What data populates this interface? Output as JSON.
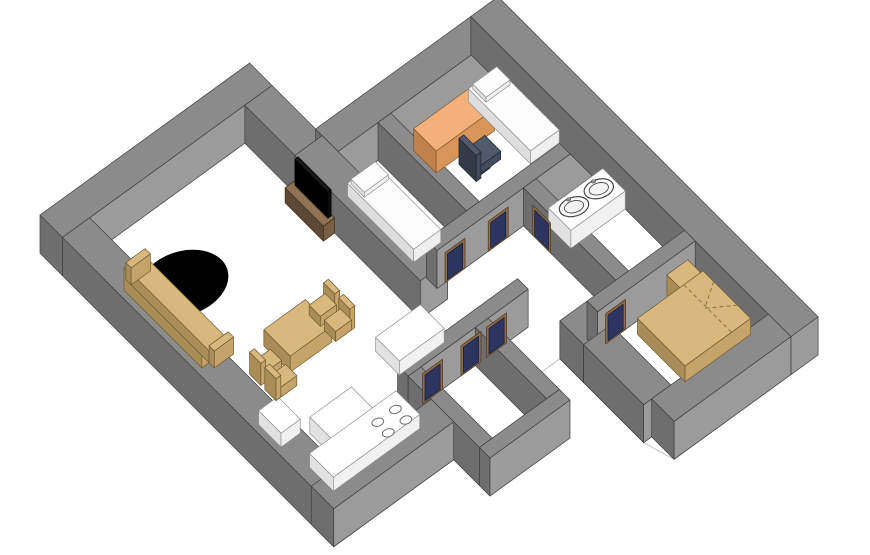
{
  "scene": {
    "width": 870,
    "height": 555,
    "background": "#ffffff",
    "label": "3D axonometric apartment floor plan rendering"
  },
  "projection": {
    "origin": [
      40,
      253
    ],
    "eu": [
      0.8,
      -0.58
    ],
    "ev": [
      0.66,
      0.66
    ],
    "wall_height": 38
  },
  "palette": {
    "wall": {
      "t": "#8b8b8b",
      "l": "#6e6e6e",
      "f": "#9b9b9b",
      "s": "#3f3f3f"
    },
    "tan": {
      "t": "#d9b87e",
      "l": "#aa8c57",
      "f": "#c4a469",
      "s": "#6e5a32"
    },
    "whitefurn": {
      "t": "#ffffff",
      "l": "#e2e2e2",
      "f": "#f1f1f1",
      "s": "#8f8f8f"
    },
    "whitebed": {
      "t": "#fdfdfd",
      "l": "#dedede",
      "f": "#efefef",
      "s": "#909090"
    },
    "orange": {
      "t": "#f2b17b",
      "l": "#bf8049",
      "f": "#d99459",
      "s": "#7b5930"
    },
    "brown": {
      "t": "#8f7355",
      "l": "#5e4a34",
      "f": "#785e43",
      "s": "#3c2f1f"
    },
    "black": {
      "t": "#1a1a1a",
      "l": "#000000",
      "f": "#101010",
      "s": "#000000"
    },
    "slate": {
      "t": "#505a6c",
      "l": "#343b48",
      "f": "#434d5d",
      "s": "#20252d"
    },
    "door": {
      "frame": "#8a6c49",
      "frame_stroke": "#57402a",
      "panel": "#2b3560",
      "panel_stroke": "#151d3a"
    },
    "floor": {
      "fill": "#ffffff",
      "stroke": "#c2c2c2"
    },
    "rug": "#000000",
    "sink_stroke": "#474747",
    "burner_stroke": "#6f6f6f",
    "bedline": "#8a744c"
  },
  "floor": {
    "name": "floor-slab",
    "pts": [
      [
        0,
        0
      ],
      [
        262,
        0
      ],
      [
        262,
        100
      ],
      [
        490,
        100
      ],
      [
        490,
        585
      ],
      [
        310,
        585
      ],
      [
        300,
        551
      ],
      [
        300,
        424
      ],
      [
        250,
        424
      ],
      [
        250,
        500
      ],
      [
        150,
        500
      ],
      [
        150,
        445
      ],
      [
        0,
        445
      ]
    ]
  },
  "walls": [
    {
      "name": "wall-nw-living",
      "u": 0,
      "v": 0,
      "du": 262,
      "dv": 34
    },
    {
      "name": "wall-jog-living-ne",
      "u": 228,
      "v": 34,
      "du": 34,
      "dv": 76
    },
    {
      "name": "wall-nw-bedrooms",
      "u": 262,
      "v": 100,
      "du": 194,
      "dv": 34
    },
    {
      "name": "wall-divider-bedrooms",
      "u": 312,
      "v": 134,
      "du": 16,
      "dv": 134
    },
    {
      "name": "wall-ne-living",
      "u": 228,
      "v": 110,
      "du": 34,
      "dv": 190
    },
    {
      "name": "wall-hall-nw",
      "u": 262,
      "v": 268,
      "du": 194,
      "dv": 16
    },
    {
      "name": "wall-bath-sw",
      "u": 370,
      "v": 284,
      "du": 16,
      "dv": 140
    },
    {
      "name": "wall-ne-outer",
      "u": 456,
      "v": 100,
      "du": 34,
      "dv": 485
    },
    {
      "name": "wall-sw-living",
      "u": 0,
      "v": 34,
      "du": 34,
      "dv": 411
    },
    {
      "name": "wall-hall-se",
      "u": 150,
      "v": 360,
      "du": 150,
      "dv": 16
    },
    {
      "name": "wall-closet-sw",
      "u": 150,
      "v": 376,
      "du": 16,
      "dv": 108
    },
    {
      "name": "wall-closet-ne",
      "u": 234,
      "v": 376,
      "du": 16,
      "dv": 108
    },
    {
      "name": "wall-closet-se",
      "u": 150,
      "v": 484,
      "du": 100,
      "dv": 16
    },
    {
      "name": "wall-se-kitchen",
      "u": 0,
      "v": 411,
      "du": 150,
      "dv": 34
    },
    {
      "name": "wall-hall-bedroom-corner",
      "u": 300,
      "v": 424,
      "du": 34,
      "dv": 36
    },
    {
      "name": "wall-bedroom3-nw",
      "u": 334,
      "v": 424,
      "du": 122,
      "dv": 16
    },
    {
      "name": "wall-bedroom3-sw",
      "u": 300,
      "v": 460,
      "du": 34,
      "dv": 91
    },
    {
      "name": "wall-se-bedrooms",
      "u": 310,
      "v": 551,
      "du": 146,
      "dv": 34
    }
  ],
  "furniture": [
    {
      "type": "rug",
      "name": "living-room-rug",
      "cu": 82,
      "cv": 118,
      "z": 0,
      "rx": 46,
      "ry": 32,
      "rot": -18
    },
    {
      "type": "box",
      "name": "sofa-back",
      "mat": "tan",
      "u": 34,
      "v": 86,
      "du": 9,
      "dv": 118,
      "z": 0,
      "h": 22
    },
    {
      "type": "box",
      "name": "sofa-seat",
      "mat": "tan",
      "u": 43,
      "v": 86,
      "du": 22,
      "dv": 118,
      "z": 0,
      "h": 12
    },
    {
      "type": "box",
      "name": "sofa-arm-left",
      "mat": "tan",
      "u": 43,
      "v": 78,
      "du": 24,
      "dv": 8,
      "z": 0,
      "h": 17
    },
    {
      "type": "box",
      "name": "sofa-arm-right",
      "mat": "tan",
      "u": 43,
      "v": 204,
      "du": 24,
      "dv": 8,
      "z": 0,
      "h": 17
    },
    {
      "type": "box",
      "name": "tv-stand",
      "mat": "brown",
      "u": 214,
      "v": 112,
      "du": 14,
      "dv": 58,
      "z": 0,
      "h": 15
    },
    {
      "type": "box",
      "name": "tv-screen",
      "mat": "black",
      "u": 223,
      "v": 116,
      "du": 4,
      "dv": 50,
      "z": 15,
      "h": 26
    },
    {
      "type": "box",
      "name": "bed1-mattress",
      "mat": "whitebed",
      "u": 264,
      "v": 146,
      "du": 34,
      "dv": 100,
      "z": 0,
      "h": 13
    },
    {
      "type": "box",
      "name": "bed1-pillow",
      "mat": "whitebed",
      "u": 266,
      "v": 149,
      "du": 30,
      "dv": 20,
      "z": 13,
      "h": 5
    },
    {
      "type": "box",
      "name": "desk",
      "mat": "orange",
      "u": 345,
      "v": 148,
      "du": 73,
      "dv": 34,
      "z": 0,
      "h": 22
    },
    {
      "type": "box",
      "name": "office-chair-base",
      "mat": "slate",
      "u": 376,
      "v": 200,
      "du": 12,
      "dv": 12,
      "z": 0,
      "h": 8
    },
    {
      "type": "box",
      "name": "office-chair-seat",
      "mat": "slate",
      "u": 368,
      "v": 194,
      "du": 28,
      "dv": 24,
      "z": 8,
      "h": 8
    },
    {
      "type": "box",
      "name": "office-chair-back",
      "mat": "slate",
      "u": 362,
      "v": 196,
      "du": 6,
      "dv": 26,
      "z": 8,
      "h": 26
    },
    {
      "type": "box",
      "name": "bed2-mattress",
      "mat": "whitebed",
      "u": 420,
      "v": 140,
      "du": 36,
      "dv": 94,
      "z": 0,
      "h": 13
    },
    {
      "type": "box",
      "name": "bed2-pillow",
      "mat": "whitebed",
      "u": 423,
      "v": 143,
      "du": 30,
      "dv": 20,
      "z": 13,
      "h": 5
    },
    {
      "type": "box",
      "name": "bathroom-counter",
      "mat": "whitefurn",
      "u": 388,
      "v": 300,
      "du": 68,
      "dv": 34,
      "z": 0,
      "h": 18
    },
    {
      "type": "sink",
      "name": "sink-left",
      "cu": 406,
      "cv": 317,
      "z": 20,
      "rx": 15,
      "ry": 9.5,
      "rot": -16
    },
    {
      "type": "sink",
      "name": "sink-right",
      "cu": 437,
      "cv": 317,
      "z": 20,
      "rx": 15,
      "ry": 9.5,
      "rot": -16
    },
    {
      "type": "box",
      "name": "nightstand",
      "mat": "tan",
      "u": 424,
      "v": 436,
      "du": 26,
      "dv": 22,
      "z": 0,
      "h": 20
    },
    {
      "type": "box",
      "name": "double-bed",
      "mat": "tan",
      "u": 374,
      "v": 452,
      "du": 82,
      "dv": 72,
      "z": 0,
      "h": 16
    },
    {
      "type": "lines",
      "name": "double-bed-blanket-folds",
      "z": 16,
      "segs": [
        [
          [
            456,
            468
          ],
          [
            430,
            486
          ]
        ],
        [
          [
            456,
            504
          ],
          [
            430,
            486
          ]
        ],
        [
          [
            432,
            452
          ],
          [
            432,
            524
          ]
        ]
      ]
    },
    {
      "type": "box",
      "name": "kitchen-counter-ne",
      "mat": "whitefurn",
      "u": 172,
      "v": 300,
      "du": 56,
      "dv": 36,
      "z": 0,
      "h": 14
    },
    {
      "type": "box",
      "name": "kitchen-island",
      "mat": "whitefurn",
      "u": 65,
      "v": 330,
      "du": 52,
      "dv": 36,
      "z": 0,
      "h": 16
    },
    {
      "type": "box",
      "name": "kitchen-cabinet-sw",
      "mat": "whitefurn",
      "u": 34,
      "v": 290,
      "du": 24,
      "dv": 34,
      "z": 0,
      "h": 14
    },
    {
      "type": "box",
      "name": "stove-counter",
      "mat": "whitefurn",
      "u": 40,
      "v": 360,
      "du": 108,
      "dv": 36,
      "z": 0,
      "h": 14
    },
    {
      "type": "burner",
      "name": "stove-burner-1",
      "cu": 112,
      "cv": 376,
      "z": 14,
      "rx": 6,
      "ry": 4,
      "rot": -16
    },
    {
      "type": "burner",
      "name": "stove-burner-2",
      "cu": 134,
      "cv": 376,
      "z": 14,
      "rx": 6,
      "ry": 4,
      "rot": -16
    },
    {
      "type": "burner",
      "name": "stove-burner-3",
      "cu": 112,
      "cv": 392,
      "z": 14,
      "rx": 6,
      "ry": 4,
      "rot": -16
    },
    {
      "type": "burner",
      "name": "stove-burner-4",
      "cu": 134,
      "cv": 392,
      "z": 14,
      "rx": 6,
      "ry": 4,
      "rot": -16
    },
    {
      "type": "box",
      "name": "dining-table",
      "mat": "tan",
      "u": 95,
      "v": 224,
      "du": 52,
      "dv": 40,
      "z": 0,
      "h": 16
    },
    {
      "type": "box",
      "name": "dining-chair-ne1-back",
      "mat": "tan",
      "u": 168,
      "v": 226,
      "du": 6,
      "dv": 17,
      "z": 0,
      "h": 22
    },
    {
      "type": "box",
      "name": "dining-chair-ne1-seat",
      "mat": "tan",
      "u": 150,
      "v": 226,
      "du": 20,
      "dv": 17,
      "z": 0,
      "h": 10
    },
    {
      "type": "box",
      "name": "dining-chair-ne2-back",
      "mat": "tan",
      "u": 168,
      "v": 249,
      "du": 6,
      "dv": 17,
      "z": 0,
      "h": 22
    },
    {
      "type": "box",
      "name": "dining-chair-ne2-seat",
      "mat": "tan",
      "u": 150,
      "v": 249,
      "du": 20,
      "dv": 17,
      "z": 0,
      "h": 10
    },
    {
      "type": "box",
      "name": "dining-chair-sw1-seat",
      "mat": "tan",
      "u": 70,
      "v": 240,
      "du": 20,
      "dv": 17,
      "z": 0,
      "h": 10
    },
    {
      "type": "box",
      "name": "dining-chair-sw1-back",
      "mat": "tan",
      "u": 64,
      "v": 240,
      "du": 6,
      "dv": 17,
      "z": 0,
      "h": 22
    },
    {
      "type": "box",
      "name": "dining-chair-sw2-seat",
      "mat": "tan",
      "u": 70,
      "v": 263,
      "du": 20,
      "dv": 17,
      "z": 0,
      "h": 10
    },
    {
      "type": "box",
      "name": "dining-chair-sw2-back",
      "mat": "tan",
      "u": 64,
      "v": 263,
      "du": 6,
      "dv": 17,
      "z": 0,
      "h": 22
    }
  ],
  "doors": [
    {
      "name": "door-closet",
      "orient": "v",
      "plane": 376,
      "a": 168,
      "b": 193,
      "z0": 0,
      "z1": 30
    },
    {
      "name": "door-kitchen-hall-1",
      "orient": "v",
      "plane": 376,
      "a": 216,
      "b": 241,
      "z0": 0,
      "z1": 30
    },
    {
      "name": "door-kitchen-hall-2",
      "orient": "v",
      "plane": 376,
      "a": 248,
      "b": 273,
      "z0": 0,
      "z1": 30
    },
    {
      "name": "door-bedroom1",
      "orient": "v",
      "plane": 284,
      "a": 272,
      "b": 297,
      "z0": 0,
      "z1": 30
    },
    {
      "name": "door-bedroom2",
      "orient": "v",
      "plane": 284,
      "a": 326,
      "b": 351,
      "z0": 0,
      "z1": 30
    },
    {
      "name": "door-bathroom",
      "orient": "u",
      "plane": 370,
      "a": 298,
      "b": 325,
      "z0": 0,
      "z1": 30
    },
    {
      "name": "door-bedroom3",
      "orient": "v",
      "plane": 440,
      "a": 344,
      "b": 369,
      "z0": 0,
      "z1": 30
    }
  ]
}
